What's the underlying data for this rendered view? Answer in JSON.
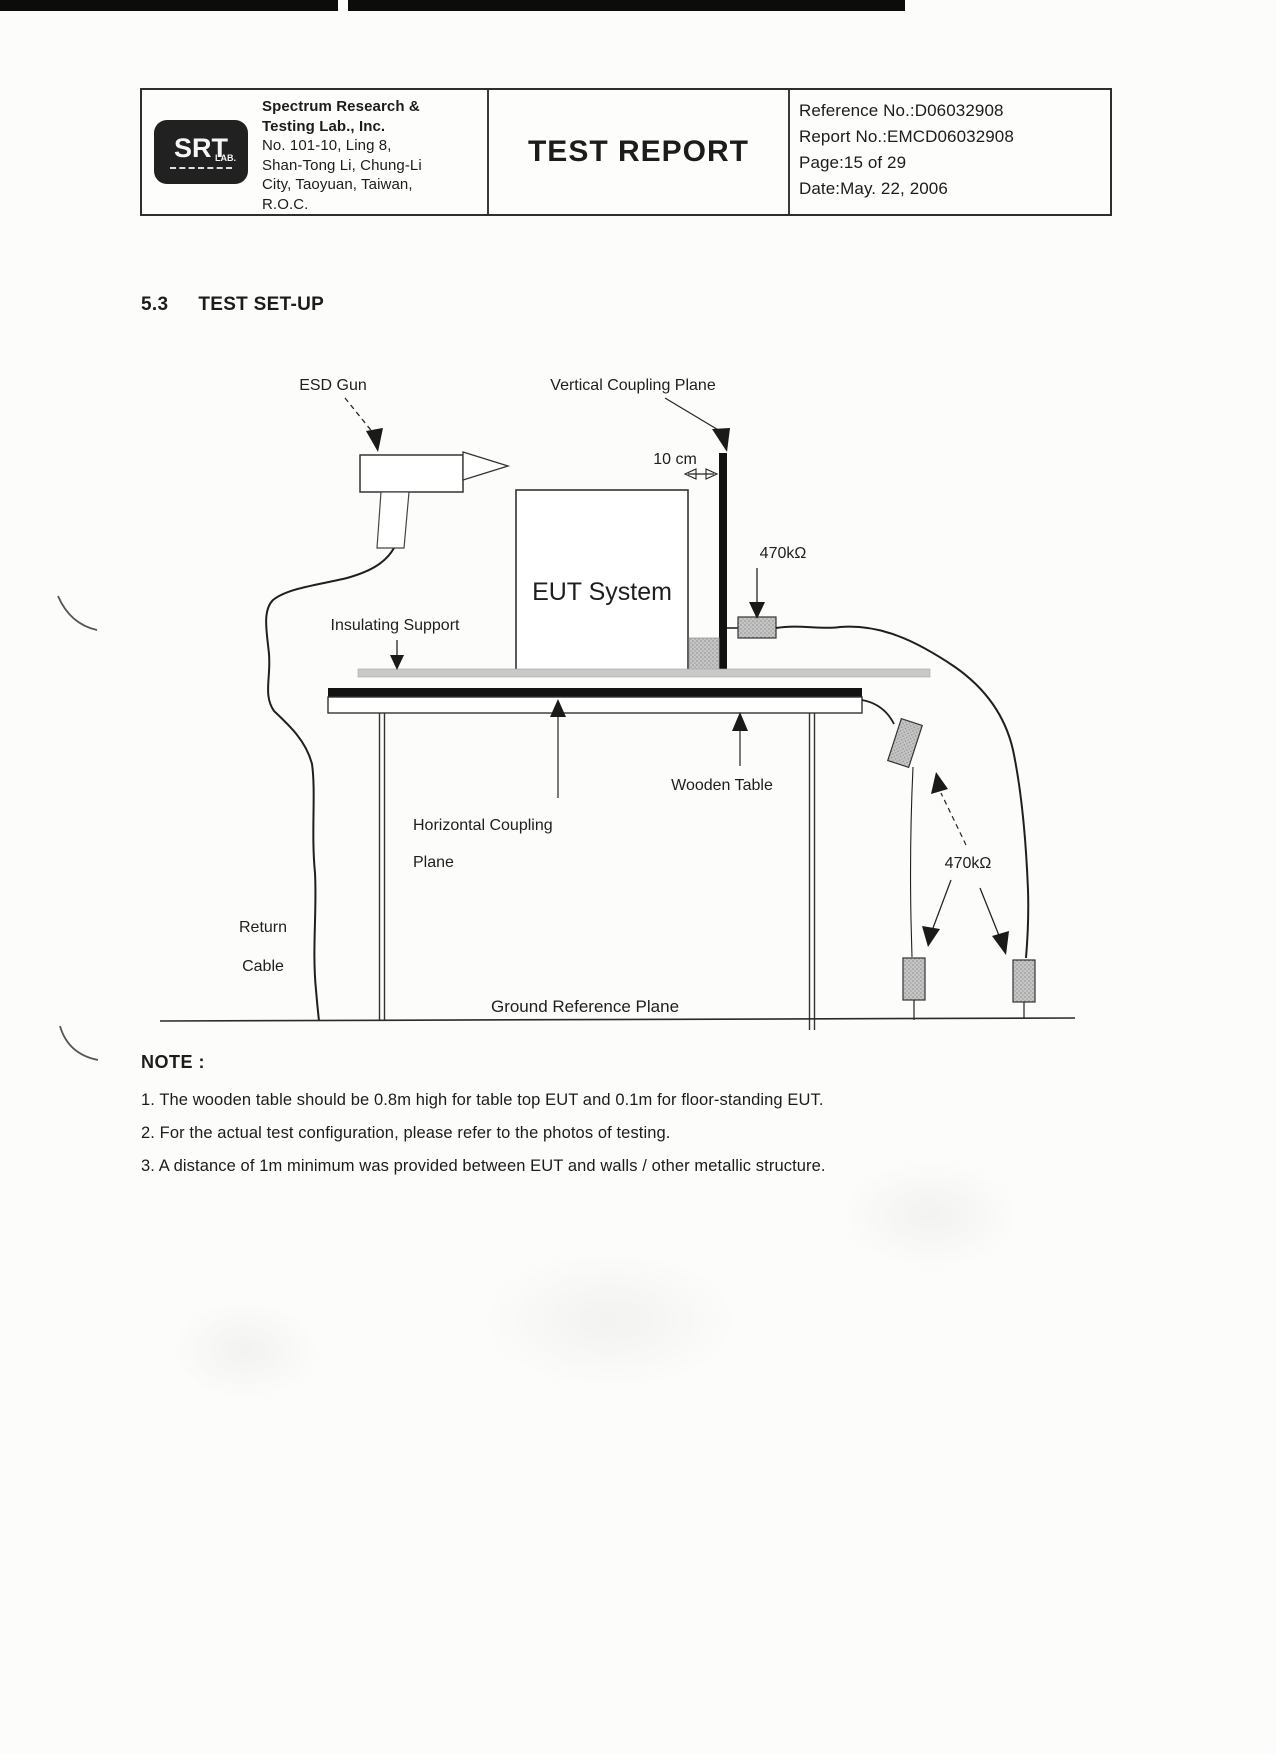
{
  "page": {
    "colors": {
      "ink": "#1c1c1c",
      "plane_fill": "#121212",
      "resistor_fill": "#c6c6c6",
      "support_strip_fill": "#c9c9c9"
    },
    "header": {
      "logo": {
        "main": "SRT",
        "sub": "LAB."
      },
      "company_lines": [
        "Spectrum Research &",
        "Testing Lab., Inc.",
        "No. 101-10, Ling 8,",
        "Shan-Tong Li, Chung-Li",
        "City, Taoyuan, Taiwan,",
        "R.O.C."
      ],
      "title": "TEST REPORT",
      "meta_lines": [
        "Reference No.:D06032908",
        "Report No.:EMCD06032908",
        "Page:15 of 29",
        "Date:May. 22, 2006"
      ]
    },
    "section": {
      "number": "5.3",
      "title": "TEST SET-UP"
    },
    "diagram": {
      "labels": {
        "esd_gun": "ESD Gun",
        "vertical_coupling_plane": "Vertical Coupling Plane",
        "distance_10cm": "10 cm",
        "resistor_top": "470kΩ",
        "eut_system": "EUT System",
        "insulating_support": "Insulating Support",
        "wooden_table": "Wooden Table",
        "horizontal_coupling_line1": "Horizontal Coupling",
        "horizontal_coupling_line2": "Plane",
        "return_cable_line1": "Return",
        "return_cable_line2": "Cable",
        "resistor_bottom": "470kΩ",
        "ground_reference_plane": "Ground Reference Plane"
      }
    },
    "note": {
      "heading": "NOTE :",
      "items": [
        "1. The wooden table should be 0.8m high for table top EUT and 0.1m for floor-standing EUT.",
        "2. For the actual test configuration, please refer to the photos of testing.",
        "3. A distance of 1m minimum was provided between EUT and walls / other metallic structure."
      ]
    }
  }
}
